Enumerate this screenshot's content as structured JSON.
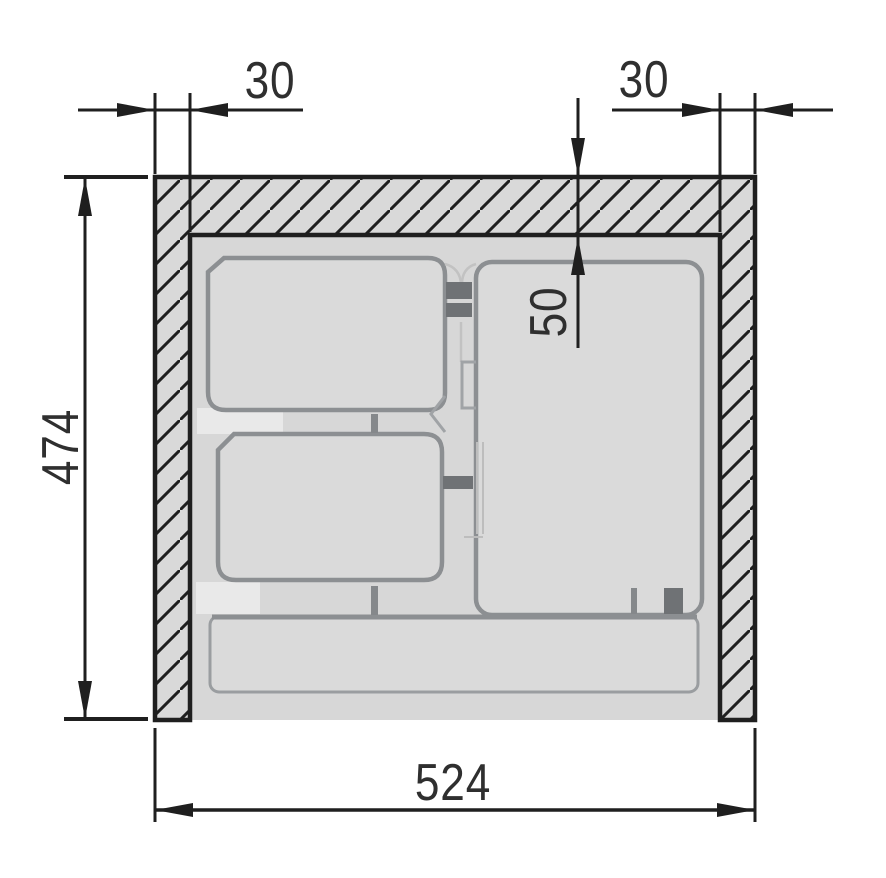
{
  "drawing": {
    "kind": "cabinet-cross-section-technical-drawing",
    "dimensions": {
      "left_wall_thickness": "30",
      "right_wall_thickness": "30",
      "top_panel_thickness": "50",
      "outer_height": "474",
      "outer_width": "524"
    },
    "colors": {
      "line": "#1f1f1f",
      "text": "#2f2f2f",
      "panel_fill": "#d9d9d9",
      "cavity_fill": "#d7d7d7",
      "tray_fill": "#dadada",
      "tray_line": "#8c8f92",
      "tray_line_light": "#c2c2c2",
      "clip_fill": "#6f7275",
      "tick_fill": "#85888b",
      "highlight": "#e9e9e9",
      "background": "#ffffff"
    }
  }
}
